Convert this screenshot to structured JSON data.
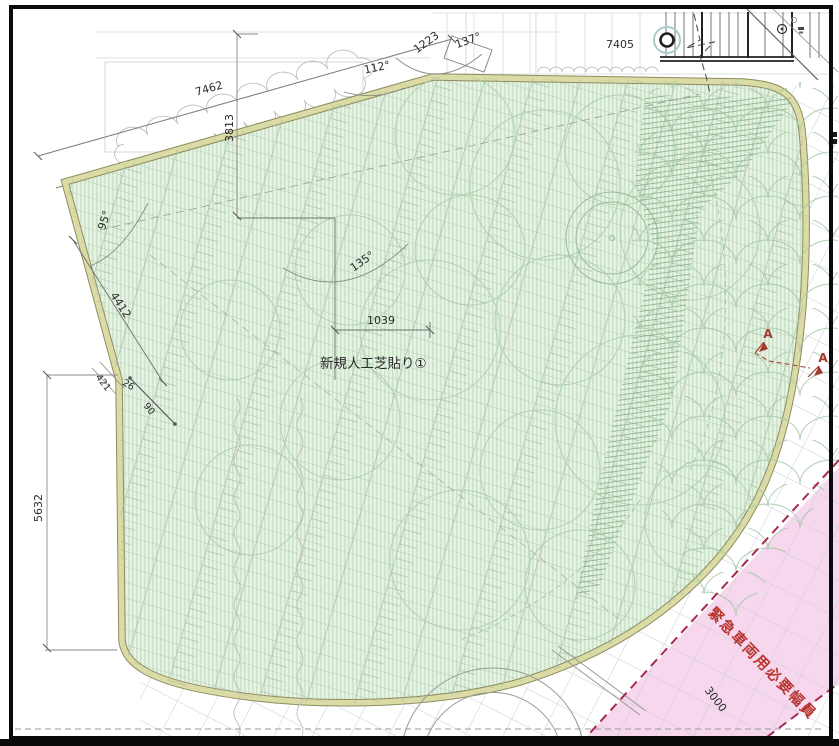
{
  "labels": {
    "turf_area": "新規人工芝貼り①",
    "emergency_width": "緊急車両用必要幅員",
    "section_a_left": "A",
    "section_a_right": "A"
  },
  "dims": {
    "slope_top": "7462",
    "vertical_top": "3813",
    "corner_edge": "1223",
    "top_width": "7405",
    "slope_left": "4412",
    "offset_small": "421",
    "offset_26": "26",
    "offset_90": "90",
    "left_height": "5632",
    "step_width": "1039",
    "emergency_band": "3000"
  },
  "angles": {
    "corner_137": "137°",
    "corner_112": "112°",
    "corner_95": "95°",
    "corner_135": "135°"
  },
  "colors": {
    "turf_base": "#e7f2e5",
    "turf_stripe": "#cbe4c9",
    "course_line": "#a9b8a9",
    "canopy_line": "#a6c8a6",
    "band_fill": "#dbdba6",
    "band_edge": "#8d8d5f",
    "grid_line": "#c9ced3",
    "dim_line": "#8a8a8a",
    "text": "#2b2b2b",
    "pink_fill": "#f6d7ee",
    "accent_red": "#b8352f",
    "dashed_red": "#a8284e",
    "teal_ring": "#a9cccc",
    "frame": "#0a0a0a"
  }
}
